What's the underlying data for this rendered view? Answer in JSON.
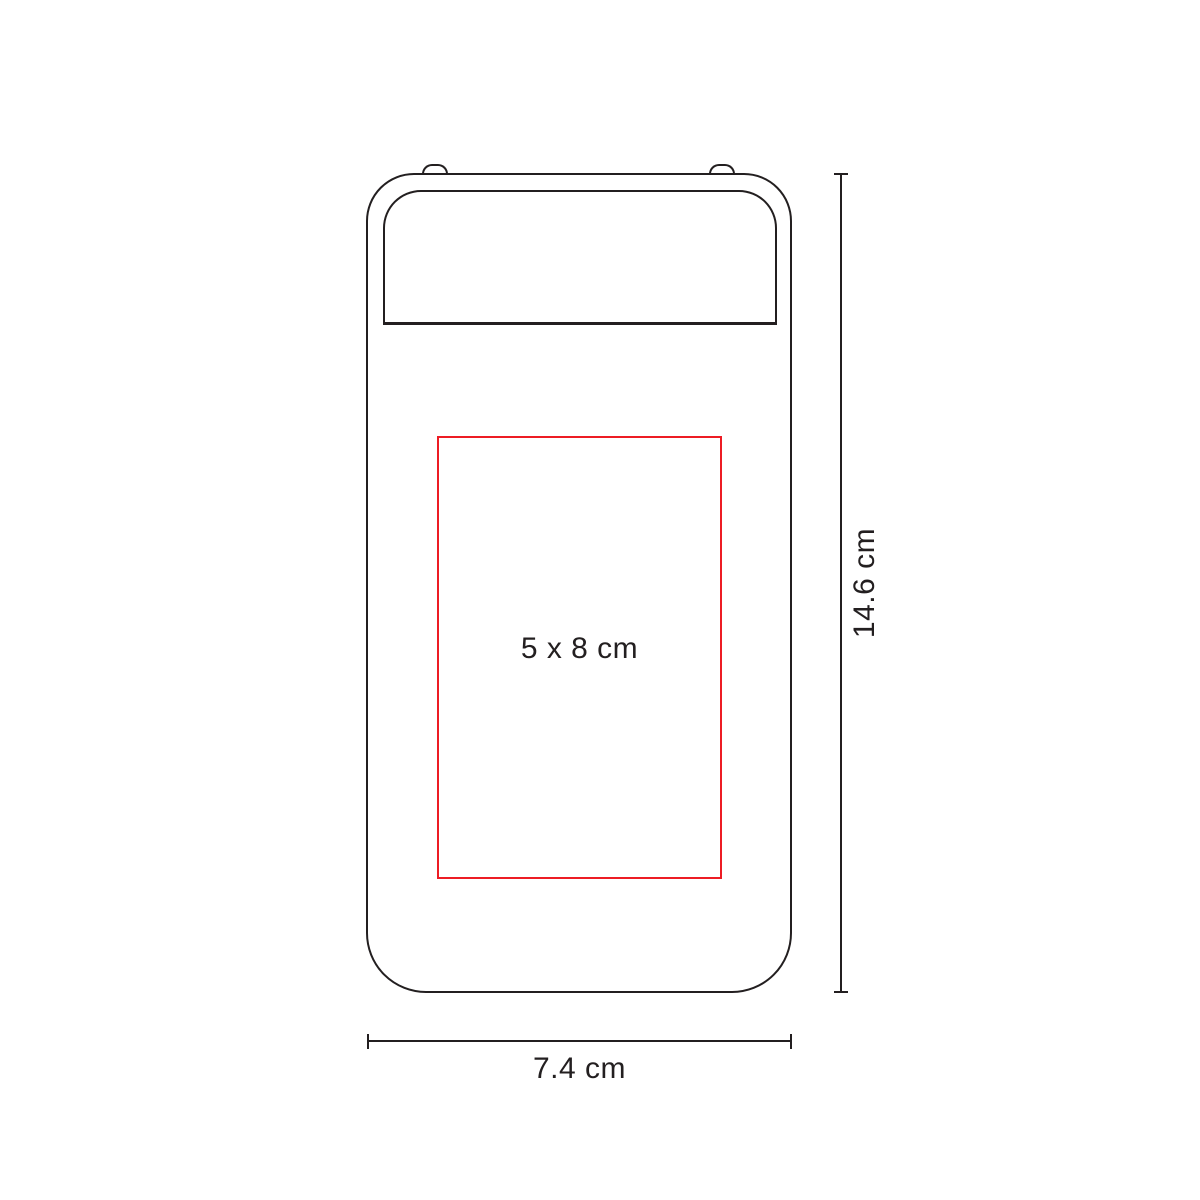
{
  "colors": {
    "outline": "#231f20",
    "accent": "#ed1c24",
    "text": "#231f20"
  },
  "print_area": {
    "label": "5 x 8 cm"
  },
  "dimensions": {
    "height": {
      "label": "14.6 cm"
    },
    "width": {
      "label": "7.4 cm"
    }
  }
}
